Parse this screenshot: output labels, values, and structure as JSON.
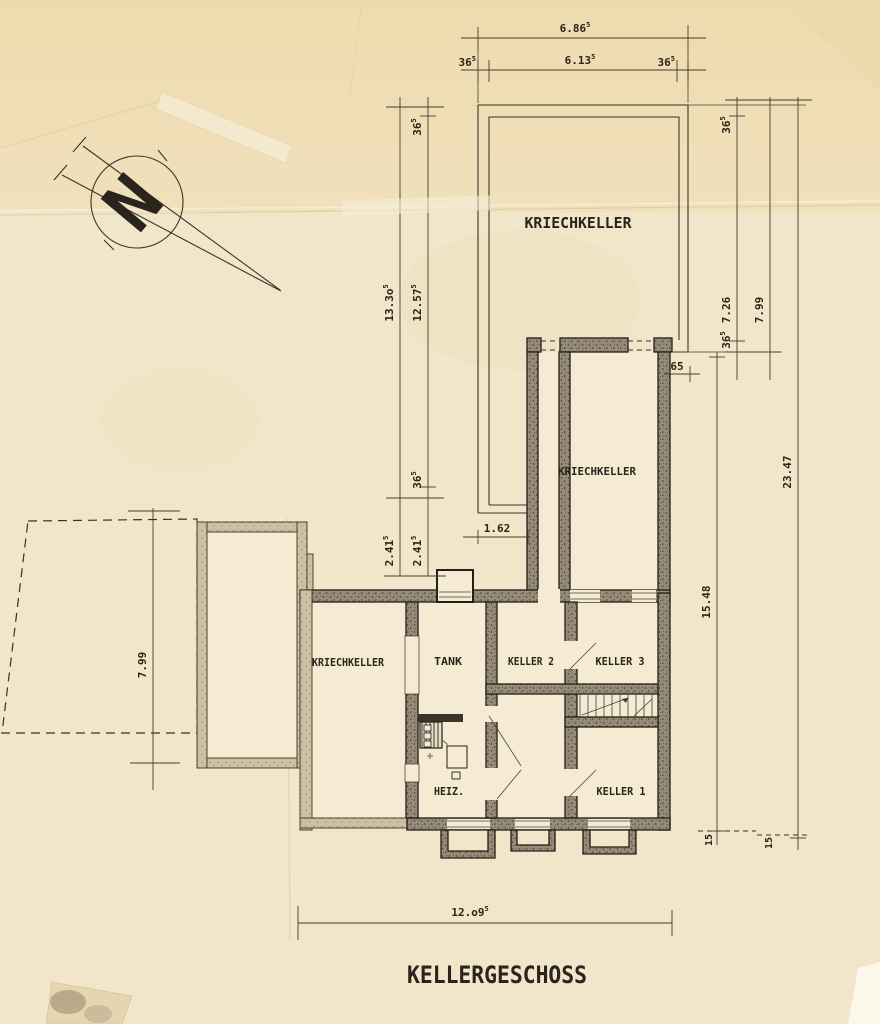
{
  "title": "KELLERGESCHOSS",
  "compass": {
    "letter": "N"
  },
  "rooms": {
    "kriechkeller_top": "KRIECHKELLER",
    "kriechkeller_mid": "KRIECHKELLER",
    "kriechkeller_left": "KRIECHKELLER",
    "tank": "TANK",
    "keller2": "KELLER 2",
    "keller3": "KELLER 3",
    "keller1": "KELLER 1",
    "heiz": "HEIZ."
  },
  "dims": {
    "top_total": {
      "v": "6.86",
      "s": "5"
    },
    "top_left_wall": {
      "v": "36",
      "s": "5"
    },
    "top_mid": {
      "v": "6.13",
      "s": "5"
    },
    "top_right_wall": {
      "v": "36",
      "s": "5"
    },
    "left_total": {
      "v": "13.3o",
      "s": "5"
    },
    "left_wall_top": {
      "v": "36",
      "s": "5"
    },
    "left_inner": {
      "v": "12.57",
      "s": "5"
    },
    "left_wall_bot": {
      "v": "36",
      "s": "5"
    },
    "left_ext_a": {
      "v": "2.41",
      "s": "5"
    },
    "left_ext_b": {
      "v": "2.41",
      "s": "5"
    },
    "right_wall_top": {
      "v": "36",
      "s": "5"
    },
    "right_upper_inner": {
      "v": "7.26",
      "s": ""
    },
    "right_wall_bot": {
      "v": "36",
      "s": "5"
    },
    "right_upper_total": {
      "v": "7.99",
      "s": ""
    },
    "right_total": {
      "v": "23.47",
      "s": ""
    },
    "right_lower": {
      "v": "15.48",
      "s": ""
    },
    "offset_65": {
      "v": "65",
      "s": ""
    },
    "gap_162": {
      "v": "1.62",
      "s": ""
    },
    "annex_height": {
      "v": "7.99",
      "s": ""
    },
    "plinth_a": {
      "v": "15",
      "s": ""
    },
    "plinth_b": {
      "v": "15",
      "s": ""
    },
    "bottom_total": {
      "v": "12.o9",
      "s": "5"
    }
  },
  "colors": {
    "paper": "#f1e6c9",
    "paper_top": "#eed9ab",
    "ink": "#2b241c",
    "wall_dark": "#978c79",
    "wall_light": "#cdc1a4"
  }
}
